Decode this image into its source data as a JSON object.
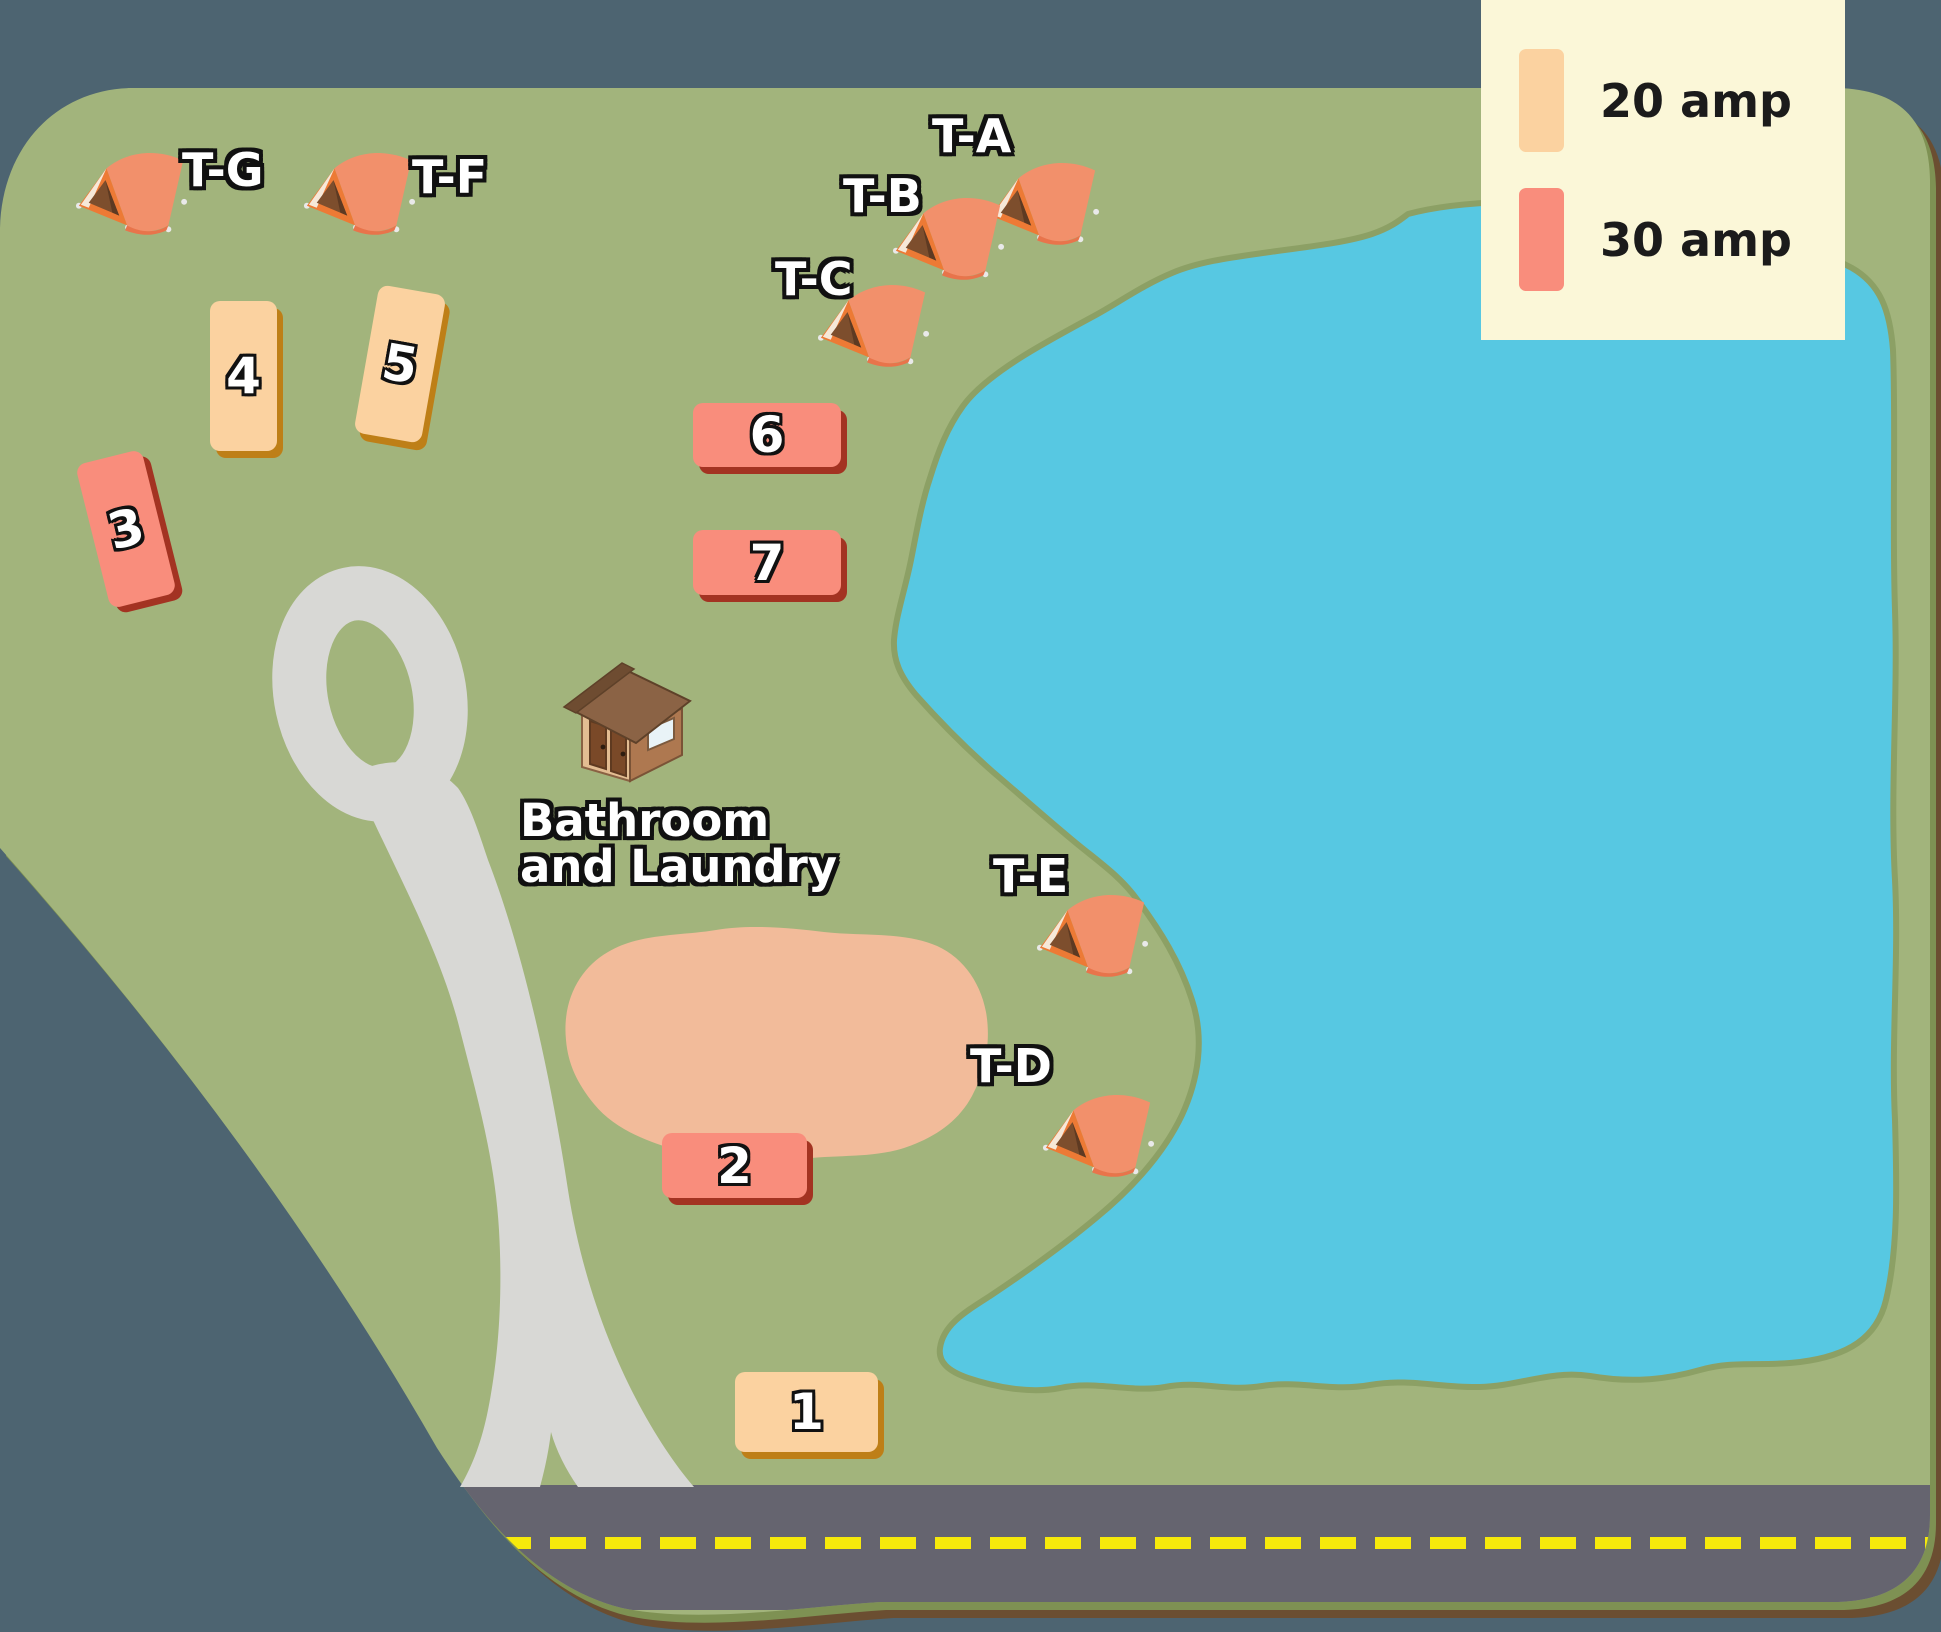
{
  "title": "Campground site map",
  "legend": {
    "items": [
      {
        "label": "20 amp",
        "icon": "20-amp-swatch",
        "color": "#FBD2A0"
      },
      {
        "label": "30 amp",
        "icon": "30-amp-swatch",
        "color": "#F98D7C"
      }
    ]
  },
  "sites": [
    {
      "label": "1",
      "amp": "20 amp"
    },
    {
      "label": "2",
      "amp": "30 amp"
    },
    {
      "label": "3",
      "amp": "30 amp"
    },
    {
      "label": "4",
      "amp": "20 amp"
    },
    {
      "label": "5",
      "amp": "20 amp"
    },
    {
      "label": "6",
      "amp": "30 amp"
    },
    {
      "label": "7",
      "amp": "30 amp"
    }
  ],
  "tents": [
    {
      "label": "T-A"
    },
    {
      "label": "T-B"
    },
    {
      "label": "T-C"
    },
    {
      "label": "T-D"
    },
    {
      "label": "T-E"
    },
    {
      "label": "T-F"
    },
    {
      "label": "T-G"
    }
  ],
  "buildings": {
    "bathroom": {
      "line1": "Bathroom",
      "line2": "and Laundry",
      "icon": "house-icon"
    }
  },
  "map_colors": {
    "background": "#4D6471",
    "grass": "#A2B47C",
    "lake": "#57C8E2",
    "lake_outline": "#8CA065",
    "road_loop": "#D8D8D5",
    "highway": "#65646F",
    "highway_line": "#F6E90B",
    "clearing": "#F2BB9A",
    "map_edge_brown": "#6B4E31",
    "map_edge_olive": "#7E9153",
    "tent_color": "#F2906B",
    "legend_bg": "#FBF7D8"
  }
}
